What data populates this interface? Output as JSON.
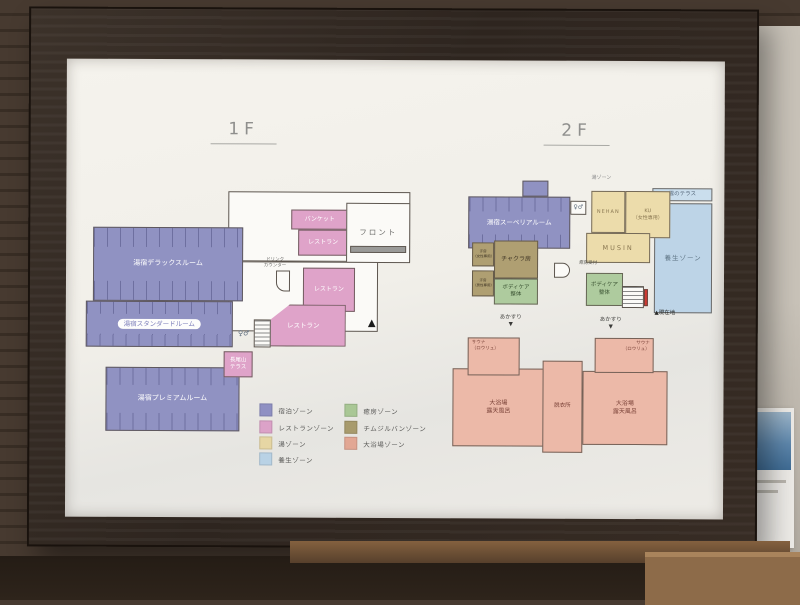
{
  "palette": {
    "purple": "#9092c2",
    "pink": "#dfa3c9",
    "cream": "#ecdcab",
    "blue": "#bdd4e7",
    "blueLight": "#cadeed",
    "green": "#aecb9e",
    "khaki": "#af9f72",
    "salmon": "#ecb9a8",
    "white": "#fbfaf7"
  },
  "poster": {
    "floors": [
      {
        "id": "f1",
        "title": "1F",
        "rooms": [
          {
            "name": "lobby-area",
            "x": 162,
            "y": 132,
            "w": 182,
            "h": 70,
            "fill": "white",
            "cls": "outline"
          },
          {
            "name": "corridor-area",
            "x": 162,
            "y": 202,
            "w": 150,
            "h": 70,
            "fill": "white",
            "cls": "outline"
          },
          {
            "name": "room-deluxe",
            "label": "湯宿デラックスルーム",
            "x": 27,
            "y": 168,
            "w": 150,
            "h": 74,
            "fill": "purple",
            "cls": "comb",
            "fs": 7,
            "labelColor": "#ffffff"
          },
          {
            "name": "room-standard",
            "label": "湯宿スタンダードルーム",
            "x": 20,
            "y": 242,
            "w": 147,
            "h": 46,
            "fill": "purple",
            "cls": "comb",
            "fs": 6.5,
            "pill": true
          },
          {
            "name": "room-premium",
            "label": "湯宿プレミアムルーム",
            "x": 40,
            "y": 308,
            "w": 134,
            "h": 64,
            "fill": "purple",
            "cls": "comb",
            "fs": 7,
            "labelColor": "#ffffff"
          },
          {
            "name": "room-banquet",
            "label": "バンケット",
            "x": 225,
            "y": 150,
            "w": 57,
            "h": 20,
            "fill": "pink",
            "fs": 6,
            "labelColor": "#ffffff"
          },
          {
            "name": "room-restaurant-upper",
            "label": "レストラン",
            "x": 232,
            "y": 170,
            "w": 50,
            "h": 26,
            "fill": "pink",
            "fs": 6,
            "labelColor": "#ffffff"
          },
          {
            "name": "room-front",
            "label": "フロント",
            "x": 280,
            "y": 143,
            "w": 64,
            "h": 60,
            "fill": "white",
            "cls": "outline",
            "fs": 7.5,
            "labelColor": "#6d6d6b",
            "ls": 2
          },
          {
            "name": "front-counter",
            "x": 284,
            "y": 186,
            "w": 56,
            "h": 7,
            "fill": "#9a9a98"
          },
          {
            "name": "room-restaurant-mid",
            "label": "レストラン",
            "x": 237,
            "y": 208,
            "w": 52,
            "h": 44,
            "fill": "pink",
            "fs": 6,
            "labelColor": "#ffffff"
          },
          {
            "name": "room-restaurant-main",
            "label": "レストラン",
            "x": 195,
            "y": 245,
            "w": 85,
            "h": 42,
            "fill": "pink",
            "fs": 6.5,
            "labelColor": "#ffffff",
            "clip": "polygon(34% 0, 100% 0, 100% 100%, 0 100%, 0 54%)"
          },
          {
            "name": "room-nagaoyama-terrace",
            "label": "長尾山\nテラス",
            "x": 158,
            "y": 292,
            "w": 29,
            "h": 26,
            "fill": "pink",
            "fs": 5.5,
            "labelColor": "#ffffff"
          },
          {
            "name": "stairs-1f",
            "x": 188,
            "y": 260,
            "w": 17,
            "h": 28,
            "fill": "white",
            "cls": "outline stairs"
          },
          {
            "name": "toilet-icons-1f",
            "label": "♀♂",
            "x": 168,
            "y": 268,
            "w": 20,
            "h": 14,
            "fs": 7,
            "labelColor": "#5a6a7a",
            "fill": "none"
          },
          {
            "name": "drink-counter-label",
            "label": "ドリンク\nカウンター",
            "x": 193,
            "y": 197,
            "w": 32,
            "h": 13,
            "fs": 4.5,
            "labelColor": "#6a6a68",
            "fill": "none"
          },
          {
            "name": "drink-counter",
            "x": 210,
            "y": 211,
            "w": 14,
            "h": 21,
            "fill": "white",
            "cls": "outline",
            "round": "0 0 0 9px"
          },
          {
            "name": "entrance-triangle",
            "label": "▲",
            "x": 298,
            "y": 256,
            "w": 16,
            "h": 14,
            "fs": 10,
            "labelColor": "#1c1c1c",
            "fill": "none"
          }
        ]
      },
      {
        "id": "f2",
        "title": "2F",
        "rooms": [
          {
            "name": "yojo-zone",
            "label": "養生ゾーン",
            "x": 588,
            "y": 142,
            "w": 58,
            "h": 110,
            "fill": "blue",
            "fs": 6.5,
            "labelColor": "#5f7585",
            "ls": 1
          },
          {
            "name": "cloud-terrace",
            "label": "雲のテラス",
            "x": 586,
            "y": 127,
            "w": 60,
            "h": 13,
            "fill": "blueLight",
            "fs": 5.5,
            "labelColor": "#55677a"
          },
          {
            "name": "room-nehan",
            "label": "NEHAN",
            "x": 525,
            "y": 130,
            "w": 34,
            "h": 42,
            "fill": "cream",
            "fs": 5,
            "labelColor": "#8a7852",
            "ls": 1
          },
          {
            "name": "room-ku",
            "label": "KU\n（女性専用）",
            "x": 559,
            "y": 130,
            "w": 45,
            "h": 47,
            "fill": "cream",
            "fs": 5,
            "labelColor": "#8a7852"
          },
          {
            "name": "room-musin",
            "label": "MUSIN",
            "x": 520,
            "y": 172,
            "w": 64,
            "h": 30,
            "fill": "cream",
            "fs": 6.5,
            "labelColor": "#8a7852",
            "ls": 2
          },
          {
            "name": "yu-zone-label",
            "label": "湯ゾーン",
            "x": 520,
            "y": 112,
            "w": 30,
            "h": 10,
            "fs": 5,
            "labelColor": "#88888a",
            "fill": "none"
          },
          {
            "name": "room-superior",
            "label": "湯宿スーペリアルーム",
            "x": 402,
            "y": 136,
            "w": 102,
            "h": 52,
            "fill": "purple",
            "cls": "comb",
            "fs": 6.5,
            "labelColor": "#ffffff"
          },
          {
            "name": "superior-tab",
            "x": 456,
            "y": 120,
            "w": 26,
            "h": 16,
            "fill": "purple"
          },
          {
            "name": "toilet-icons-2f",
            "label": "♀♂",
            "x": 504,
            "y": 140,
            "w": 16,
            "h": 14,
            "fs": 6,
            "labelColor": "#5a6a7a",
            "fill": "white",
            "cls": "outline"
          },
          {
            "name": "room-kanbo-w",
            "label": "汗房\n（女性専用）",
            "x": 406,
            "y": 182,
            "w": 22,
            "h": 24,
            "fill": "khaki",
            "fs": 3.5,
            "labelColor": "#3f3525"
          },
          {
            "name": "room-kanbo-m",
            "label": "汗房\n（男性専用）",
            "x": 406,
            "y": 210,
            "w": 22,
            "h": 26,
            "fill": "khaki",
            "fs": 3.5,
            "labelColor": "#3f3525"
          },
          {
            "name": "room-chakra",
            "label": "チャクラ房",
            "x": 428,
            "y": 180,
            "w": 44,
            "h": 38,
            "fill": "khaki",
            "fs": 6,
            "labelColor": "#3f3525"
          },
          {
            "name": "room-bodycare-left",
            "label": "ボディケア\n整体",
            "x": 428,
            "y": 218,
            "w": 44,
            "h": 26,
            "fill": "green",
            "fs": 5.5,
            "labelColor": "#3a5232"
          },
          {
            "name": "room-bodycare-right",
            "label": "ボディケア\n整体",
            "x": 520,
            "y": 212,
            "w": 37,
            "h": 33,
            "fill": "green",
            "fs": 5.5,
            "labelColor": "#3a5232"
          },
          {
            "name": "yubo-reception-label",
            "label": "癒房受付",
            "x": 508,
            "y": 198,
            "w": 28,
            "h": 9,
            "fs": 4.5,
            "labelColor": "#55554f",
            "fill": "none"
          },
          {
            "name": "reception-counter",
            "x": 488,
            "y": 202,
            "w": 16,
            "h": 15,
            "fill": "white",
            "cls": "outline",
            "round": "0 8px 8px 0"
          },
          {
            "name": "stairs-2f",
            "x": 556,
            "y": 225,
            "w": 22,
            "h": 22,
            "fill": "white",
            "cls": "outline stairs"
          },
          {
            "name": "current-location-marker",
            "x": 578,
            "y": 228,
            "w": 4,
            "h": 17,
            "fill": "#cf3a33"
          },
          {
            "name": "current-location-label",
            "label": "▲現在地",
            "x": 580,
            "y": 248,
            "w": 38,
            "h": 10,
            "fs": 5.5,
            "labelColor": "#2a2a28",
            "fill": "none"
          },
          {
            "name": "akasuri-left",
            "label": "あかすり\n▼",
            "x": 430,
            "y": 252,
            "w": 30,
            "h": 18,
            "fs": 5.5,
            "labelColor": "#3a3a38",
            "fill": "none"
          },
          {
            "name": "akasuri-right",
            "label": "あかすり\n▼",
            "x": 530,
            "y": 254,
            "w": 30,
            "h": 18,
            "fs": 5.5,
            "labelColor": "#3a3a38",
            "fill": "none"
          },
          {
            "name": "room-bath-left",
            "label": "大浴場\n露天風呂",
            "x": 387,
            "y": 308,
            "w": 92,
            "h": 78,
            "fill": "salmon",
            "fs": 6,
            "labelColor": "#7a4238"
          },
          {
            "name": "room-bath-right",
            "label": "大浴場\n露天風呂",
            "x": 517,
            "y": 310,
            "w": 85,
            "h": 74,
            "fill": "salmon",
            "fs": 6,
            "labelColor": "#7a4238"
          },
          {
            "name": "room-datsuijo",
            "label": "脱衣所",
            "x": 477,
            "y": 300,
            "w": 40,
            "h": 92,
            "fill": "salmon",
            "fs": 5.5,
            "labelColor": "#7a4238"
          },
          {
            "name": "room-sauna-left",
            "label": "サウナ\n（ロウリュ）",
            "x": 402,
            "y": 277,
            "w": 52,
            "h": 38,
            "fill": "salmon",
            "cls": "label-tl",
            "fs": 4.5,
            "labelColor": "#7a4238"
          },
          {
            "name": "room-sauna-right",
            "label": "サウナ\n（ロウリュ）",
            "x": 529,
            "y": 277,
            "w": 59,
            "h": 35,
            "fill": "salmon",
            "cls": "label-tr",
            "fs": 4.5,
            "labelColor": "#7a4238"
          }
        ]
      }
    ],
    "legend": {
      "items": [
        {
          "label": "宿泊ゾーン",
          "color": "#8f90c3",
          "x": 0,
          "y": 2
        },
        {
          "label": "レストランゾーン",
          "color": "#dca2c8",
          "x": 0,
          "y": 19
        },
        {
          "label": "湯ゾーン",
          "color": "#e6d6a4",
          "x": 0,
          "y": 35
        },
        {
          "label": "養生ゾーン",
          "color": "#b9d2e5",
          "x": 0,
          "y": 51
        },
        {
          "label": "癒房ゾーン",
          "color": "#a9c795",
          "x": 85,
          "y": 2
        },
        {
          "label": "チムジルバンゾーン",
          "color": "#a89b6d",
          "x": 85,
          "y": 19
        },
        {
          "label": "大浴場ゾーン",
          "color": "#e2a794",
          "x": 85,
          "y": 35
        }
      ]
    }
  }
}
